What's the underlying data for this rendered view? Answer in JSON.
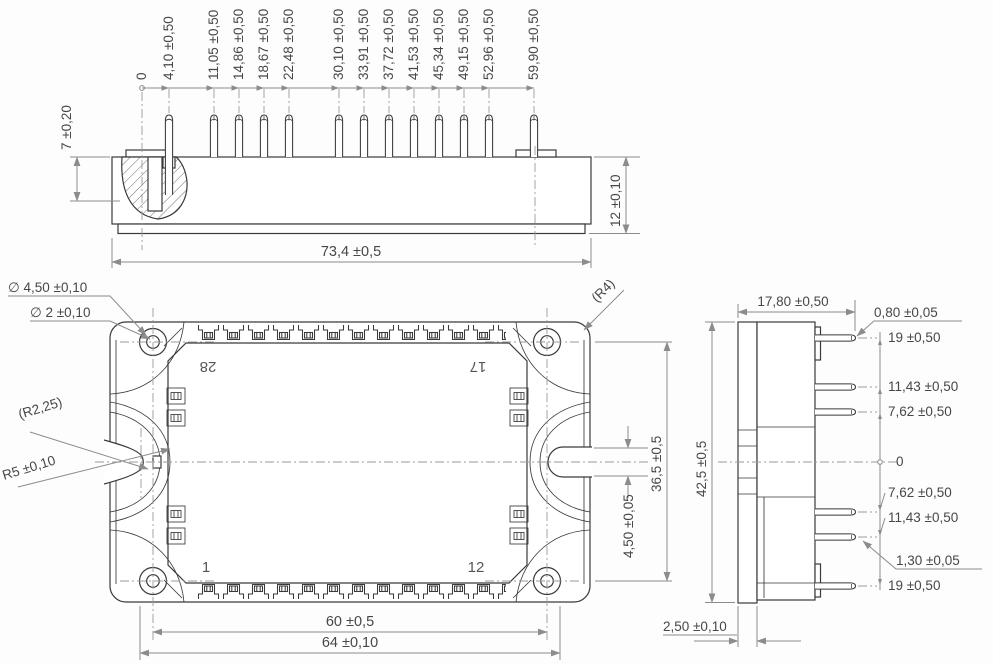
{
  "front_view": {
    "ordinate_labels": [
      "0",
      "4,10 ±0,50",
      "11,05 ±0,50",
      "14,86 ±0,50",
      "18,67 ±0,50",
      "22,48 ±0,50",
      "30,10 ±0,50",
      "33,91 ±0,50",
      "37,72 ±0,50",
      "41,53 ±0,50",
      "45,34 ±0,50",
      "49,15 ±0,50",
      "52,96 ±0,50",
      "59,90 ±0,50"
    ],
    "dim_pin_height": "7 ±0,20",
    "dim_body_height": "12 ±0,10",
    "dim_width": "73,4 ±0,5"
  },
  "top_view": {
    "dim_hole_outer": "∅ 4,50 ±0,10",
    "dim_hole_inner": "∅ 2 ±0,10",
    "dim_corner_radius": "(R4)",
    "dim_notch_small_radius": "(R2,25)",
    "dim_notch_radius": "R5 ±0,10",
    "dim_hole_span_v": "36,5 ±0,5",
    "dim_slot_width": "4,50 ±0,05",
    "dim_hole_span_h": "60 ±0,5",
    "dim_outer_width": "64 ±0,10",
    "pin_28": "28",
    "pin_17": "17",
    "pin_1": "1",
    "pin_12": "12"
  },
  "side_view": {
    "dim_depth": "17,80 ±0,50",
    "dim_pin_thickness_top": "0,80 ±0,05",
    "rows": [
      "19 ±0,50",
      "11,43 ±0,50",
      "7,62 ±0,50",
      "0",
      "7,62 ±0,50",
      "11,43 ±0,50",
      "1,30 ±0,05",
      "19 ±0,50"
    ],
    "dim_height": "42,5 ±0,5",
    "dim_baseplate": "2,50 ±0,10"
  }
}
